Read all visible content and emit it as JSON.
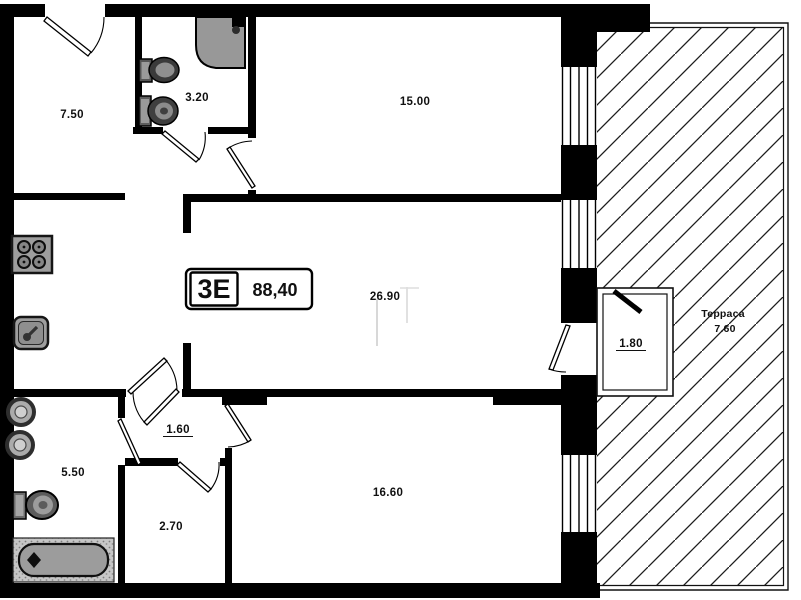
{
  "unit": {
    "type_label": "3Е",
    "total_area": "88,40"
  },
  "rooms": {
    "hall_top": "7.50",
    "bath_top": "3.20",
    "bed_top": "15.00",
    "living_kitchen": "26.90",
    "balcony_vestibule": "1.80",
    "hall_bottom": "1.60",
    "bath_bottom": "5.50",
    "closet": "2.70",
    "bed_bottom": "16.60"
  },
  "terrace": {
    "name": "Терраса",
    "area": "7.60"
  },
  "icons": {
    "fixtures": [
      "shower-icon",
      "sink-icon",
      "toilet-icon",
      "stove-icon",
      "kitchen-sink-icon",
      "washbasin-icon",
      "bathtub-icon"
    ]
  },
  "colors": {
    "wall": "#000000",
    "paper": "#ffffff",
    "fixture_gray": "#9c9c9c",
    "hatch_line": "#1c1c1c"
  }
}
